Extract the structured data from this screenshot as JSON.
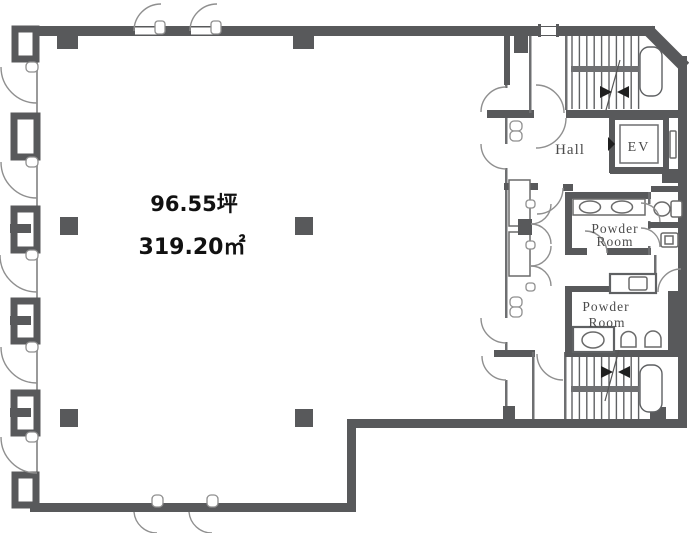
{
  "plan": {
    "area": {
      "tsubo": "96.55坪",
      "sqm": "319.20㎡"
    },
    "rooms": {
      "hall": "Hall",
      "ev": "EV",
      "powder_upper_line1": "Powder",
      "powder_upper_line2": "Room",
      "powder_lower_line1": "Powder",
      "powder_lower_line2": "Room"
    },
    "colors": {
      "wall": "#58595b",
      "thin_line": "#6e6f71",
      "door_arc": "#8f8f8f",
      "area_text": "#111111",
      "room_label": "#4b4b4b",
      "background": "#ffffff"
    }
  }
}
